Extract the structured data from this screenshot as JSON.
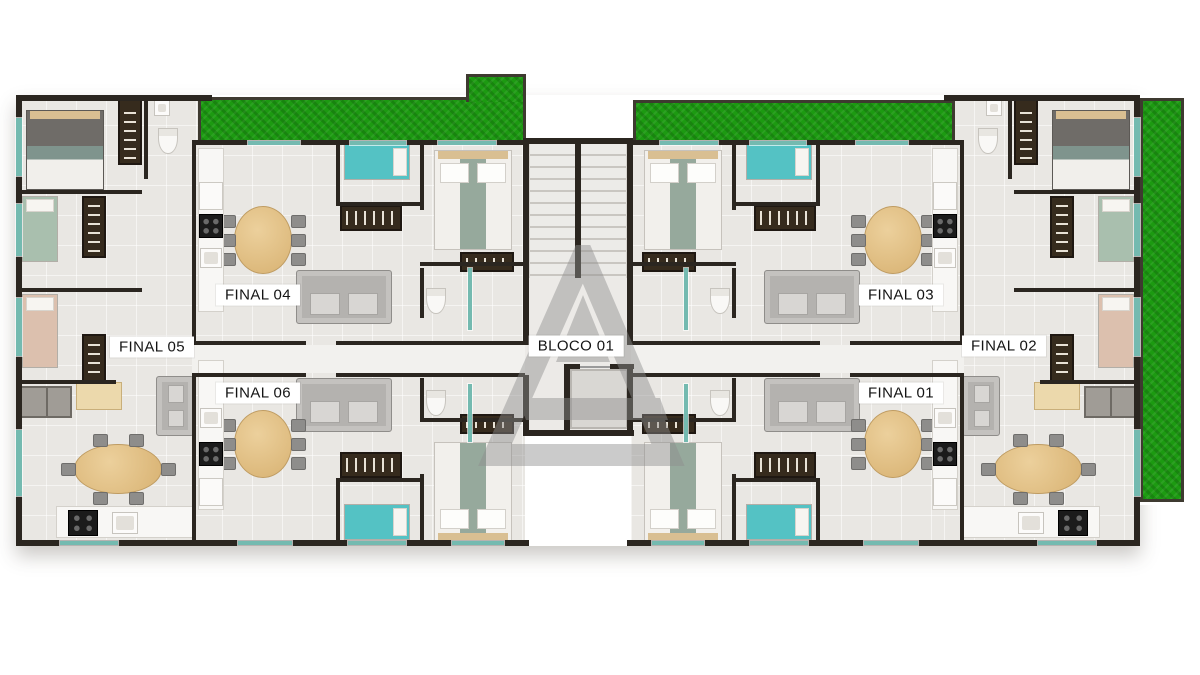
{
  "page_title": "Planta baixa - pavimento tipo",
  "block_label": {
    "text": "BLOCO 01",
    "cx": 576,
    "cy": 346
  },
  "unit_labels": [
    {
      "text": "FINAL 04",
      "cx": 258,
      "cy": 295
    },
    {
      "text": "FINAL 05",
      "cx": 152,
      "cy": 347
    },
    {
      "text": "FINAL 06",
      "cx": 258,
      "cy": 393
    },
    {
      "text": "FINAL 03",
      "cx": 901,
      "cy": 295
    },
    {
      "text": "FINAL 02",
      "cx": 1004,
      "cy": 346
    },
    {
      "text": "FINAL 01",
      "cx": 901,
      "cy": 393
    }
  ],
  "colors": {
    "background": "#ffffff",
    "wall": "#2b2620",
    "floor": "#e9e7e3",
    "hall_floor": "#f2f1ee",
    "grass": "#1c9a11",
    "window_glass": "#74bab0",
    "teal_bed": "#54c2c4",
    "green_bed": "#a9bfae",
    "pink_bed": "#dcc0ae",
    "wood_table": "#d8b272",
    "dark_cabinet": "#362b1d",
    "sofa_gray": "#b4b2af",
    "watermark_gray": "#8e8e8e"
  },
  "scene": {
    "shadow_base": {
      "x": 16,
      "y": 95,
      "w": 1124,
      "h": 451
    },
    "floors": [
      {
        "x": 16,
        "y": 95,
        "w": 196,
        "h": 451,
        "kind": "unit"
      },
      {
        "x": 192,
        "y": 140,
        "w": 333,
        "h": 406,
        "kind": "unit"
      },
      {
        "x": 631,
        "y": 140,
        "w": 333,
        "h": 406,
        "kind": "unit"
      },
      {
        "x": 944,
        "y": 95,
        "w": 196,
        "h": 451,
        "kind": "unit"
      },
      {
        "x": 523,
        "y": 138,
        "w": 110,
        "h": 298,
        "kind": "core"
      },
      {
        "x": 192,
        "y": 345,
        "w": 333,
        "h": 28,
        "kind": "hall"
      },
      {
        "x": 631,
        "y": 345,
        "w": 333,
        "h": 28,
        "kind": "hall"
      },
      {
        "x": 570,
        "y": 369,
        "w": 58,
        "h": 60,
        "kind": "elev"
      }
    ],
    "stairs": {
      "x": 529,
      "y": 144,
      "w": 98,
      "h": 134
    },
    "grass": [
      {
        "x": 198,
        "y": 97,
        "w": 328,
        "h": 46
      },
      {
        "x": 466,
        "y": 74,
        "w": 60,
        "h": 28,
        "notch": true
      },
      {
        "x": 633,
        "y": 100,
        "w": 322,
        "h": 43
      },
      {
        "x": 1140,
        "y": 98,
        "w": 44,
        "h": 404,
        "ringed": true
      }
    ],
    "walls": [
      [
        16,
        95,
        6,
        451
      ],
      [
        1134,
        95,
        6,
        451
      ],
      [
        16,
        95,
        196,
        6
      ],
      [
        944,
        95,
        196,
        6
      ],
      [
        192,
        140,
        333,
        5
      ],
      [
        631,
        140,
        333,
        5
      ],
      [
        523,
        138,
        110,
        6
      ],
      [
        16,
        540,
        513,
        6
      ],
      [
        627,
        540,
        513,
        6
      ],
      [
        523,
        138,
        6,
        207
      ],
      [
        627,
        138,
        6,
        207
      ],
      [
        523,
        375,
        6,
        61
      ],
      [
        627,
        364,
        6,
        72
      ],
      [
        523,
        430,
        110,
        6
      ],
      [
        575,
        140,
        6,
        138
      ],
      [
        192,
        140,
        4,
        205
      ],
      [
        192,
        373,
        4,
        173
      ],
      [
        960,
        140,
        4,
        205
      ],
      [
        960,
        373,
        4,
        173
      ],
      [
        192,
        341,
        114,
        4
      ],
      [
        336,
        341,
        189,
        4
      ],
      [
        192,
        373,
        114,
        4
      ],
      [
        336,
        373,
        189,
        4
      ],
      [
        850,
        341,
        114,
        4
      ],
      [
        631,
        341,
        189,
        4
      ],
      [
        850,
        373,
        114,
        4
      ],
      [
        631,
        373,
        189,
        4
      ],
      [
        144,
        95,
        4,
        84
      ],
      [
        1008,
        95,
        4,
        84
      ],
      [
        20,
        190,
        122,
        4
      ],
      [
        20,
        288,
        122,
        4
      ],
      [
        20,
        380,
        96,
        4
      ],
      [
        1014,
        190,
        122,
        4
      ],
      [
        1014,
        288,
        122,
        4
      ],
      [
        1040,
        380,
        96,
        4
      ],
      [
        336,
        140,
        4,
        66
      ],
      [
        336,
        202,
        84,
        4
      ],
      [
        420,
        140,
        4,
        70
      ],
      [
        420,
        262,
        107,
        4
      ],
      [
        420,
        268,
        4,
        50
      ],
      [
        816,
        140,
        4,
        66
      ],
      [
        736,
        202,
        84,
        4
      ],
      [
        732,
        140,
        4,
        70
      ],
      [
        629,
        262,
        107,
        4
      ],
      [
        732,
        268,
        4,
        50
      ],
      [
        336,
        480,
        4,
        64
      ],
      [
        336,
        478,
        84,
        4
      ],
      [
        420,
        474,
        4,
        68
      ],
      [
        420,
        418,
        107,
        4
      ],
      [
        420,
        378,
        4,
        40
      ],
      [
        816,
        480,
        4,
        64
      ],
      [
        736,
        478,
        84,
        4
      ],
      [
        732,
        474,
        4,
        68
      ],
      [
        629,
        418,
        107,
        4
      ],
      [
        732,
        378,
        4,
        40
      ],
      [
        564,
        364,
        6,
        72
      ],
      [
        564,
        364,
        16,
        5
      ],
      [
        610,
        364,
        24,
        5
      ],
      [
        564,
        430,
        70,
        6
      ]
    ],
    "windows": [
      [
        16,
        118,
        6,
        58
      ],
      [
        16,
        204,
        6,
        52
      ],
      [
        16,
        298,
        6,
        58
      ],
      [
        16,
        430,
        6,
        66
      ],
      [
        1134,
        118,
        6,
        58
      ],
      [
        1134,
        204,
        6,
        52
      ],
      [
        1134,
        298,
        6,
        58
      ],
      [
        1134,
        430,
        6,
        66
      ],
      [
        248,
        141,
        52,
        4
      ],
      [
        350,
        141,
        56,
        4
      ],
      [
        438,
        141,
        58,
        4
      ],
      [
        856,
        141,
        52,
        4
      ],
      [
        750,
        141,
        56,
        4
      ],
      [
        660,
        141,
        58,
        4
      ],
      [
        238,
        541,
        54,
        4
      ],
      [
        348,
        541,
        58,
        4
      ],
      [
        452,
        541,
        52,
        4
      ],
      [
        864,
        541,
        54,
        4
      ],
      [
        750,
        541,
        58,
        4
      ],
      [
        652,
        541,
        52,
        4
      ],
      [
        60,
        541,
        58,
        4
      ],
      [
        1038,
        541,
        58,
        4
      ],
      [
        468,
        268,
        4,
        62
      ],
      [
        684,
        268,
        4,
        62
      ],
      [
        468,
        384,
        4,
        58
      ],
      [
        684,
        384,
        4,
        58
      ]
    ],
    "elevator_door_line": {
      "x": 580,
      "y": 366,
      "w": 30,
      "h": 2
    },
    "furniture": [
      [
        "bedD",
        26,
        110,
        78,
        80
      ],
      [
        "bedD",
        1052,
        110,
        78,
        80
      ],
      [
        "bedW",
        434,
        150,
        78,
        100
      ],
      [
        "bedW",
        644,
        150,
        78,
        100
      ],
      [
        "bedW",
        434,
        442,
        78,
        100,
        "flip"
      ],
      [
        "bedW",
        644,
        442,
        78,
        100,
        "flip"
      ],
      [
        "bedS",
        344,
        144,
        66,
        36,
        "#54c2c4"
      ],
      [
        "bedS",
        746,
        144,
        66,
        36,
        "#54c2c4"
      ],
      [
        "bedS",
        344,
        504,
        66,
        36,
        "#54c2c4"
      ],
      [
        "bedS",
        746,
        504,
        66,
        36,
        "#54c2c4"
      ],
      [
        "bedS",
        22,
        196,
        36,
        66,
        "#a9bfae"
      ],
      [
        "bedS",
        1098,
        196,
        36,
        66,
        "#a9bfae"
      ],
      [
        "bedS",
        22,
        294,
        36,
        74,
        "#dcc0ae"
      ],
      [
        "bedS",
        1098,
        294,
        36,
        74,
        "#dcc0ae"
      ],
      [
        "ward",
        118,
        99,
        24,
        66
      ],
      [
        "ward",
        1014,
        99,
        24,
        66
      ],
      [
        "ward",
        82,
        196,
        24,
        62
      ],
      [
        "ward",
        1050,
        196,
        24,
        62
      ],
      [
        "ward",
        82,
        334,
        24,
        54
      ],
      [
        "ward",
        1050,
        334,
        24,
        54
      ],
      [
        "ward",
        460,
        252,
        54,
        20
      ],
      [
        "ward",
        642,
        252,
        54,
        20
      ],
      [
        "ward",
        460,
        414,
        54,
        20
      ],
      [
        "ward",
        642,
        414,
        54,
        20
      ],
      [
        "tv",
        340,
        205,
        62,
        26
      ],
      [
        "tv",
        754,
        205,
        62,
        26
      ],
      [
        "tv",
        340,
        452,
        62,
        26
      ],
      [
        "tv",
        754,
        452,
        62,
        26
      ],
      [
        "sofa",
        296,
        270,
        96,
        54
      ],
      [
        "sofa",
        764,
        270,
        96,
        54
      ],
      [
        "sofa",
        296,
        378,
        96,
        54
      ],
      [
        "sofa",
        764,
        378,
        96,
        54
      ],
      [
        "sofa",
        156,
        376,
        38,
        60
      ],
      [
        "sofa",
        962,
        376,
        38,
        60
      ],
      [
        "table",
        74,
        444,
        88,
        50
      ],
      [
        "table",
        994,
        444,
        88,
        50
      ],
      [
        "table",
        234,
        206,
        58,
        68
      ],
      [
        "table",
        864,
        206,
        58,
        68
      ],
      [
        "table",
        234,
        410,
        58,
        68
      ],
      [
        "table",
        864,
        410,
        58,
        68
      ],
      [
        "counter",
        198,
        148,
        26,
        164
      ],
      [
        "counter",
        932,
        148,
        26,
        164
      ],
      [
        "counter",
        198,
        360,
        26,
        150
      ],
      [
        "counter",
        932,
        360,
        26,
        150
      ],
      [
        "counter",
        56,
        506,
        138,
        32
      ],
      [
        "counter",
        962,
        506,
        138,
        32
      ],
      [
        "stove",
        68,
        510,
        30,
        26
      ],
      [
        "stove",
        1058,
        510,
        30,
        26
      ],
      [
        "stove",
        199,
        214,
        24,
        24
      ],
      [
        "stove",
        933,
        214,
        24,
        24
      ],
      [
        "stove",
        199,
        442,
        24,
        24
      ],
      [
        "stove",
        933,
        442,
        24,
        24
      ],
      [
        "sink",
        112,
        512,
        26,
        22
      ],
      [
        "sink",
        1018,
        512,
        26,
        22
      ],
      [
        "sink",
        200,
        248,
        22,
        20
      ],
      [
        "sink",
        934,
        248,
        22,
        20
      ],
      [
        "sink",
        200,
        408,
        22,
        20
      ],
      [
        "sink",
        934,
        408,
        22,
        20
      ],
      [
        "sink",
        154,
        100,
        16,
        16
      ],
      [
        "sink",
        986,
        100,
        16,
        16
      ],
      [
        "fridge",
        199,
        182,
        24,
        28
      ],
      [
        "fridge",
        933,
        182,
        24,
        28
      ],
      [
        "fridge",
        199,
        478,
        24,
        28
      ],
      [
        "fridge",
        933,
        478,
        24,
        28
      ],
      [
        "toilet",
        158,
        128,
        20,
        26
      ],
      [
        "toilet",
        978,
        128,
        20,
        26
      ],
      [
        "toilet",
        426,
        288,
        20,
        26
      ],
      [
        "toilet",
        710,
        288,
        20,
        26
      ],
      [
        "toilet",
        426,
        390,
        20,
        26
      ],
      [
        "toilet",
        710,
        390,
        20,
        26
      ],
      [
        "closet",
        20,
        386,
        52,
        32
      ],
      [
        "closet",
        1084,
        386,
        52,
        32
      ],
      [
        "desk",
        76,
        382,
        46,
        28
      ],
      [
        "desk",
        1034,
        382,
        46,
        28
      ]
    ]
  }
}
